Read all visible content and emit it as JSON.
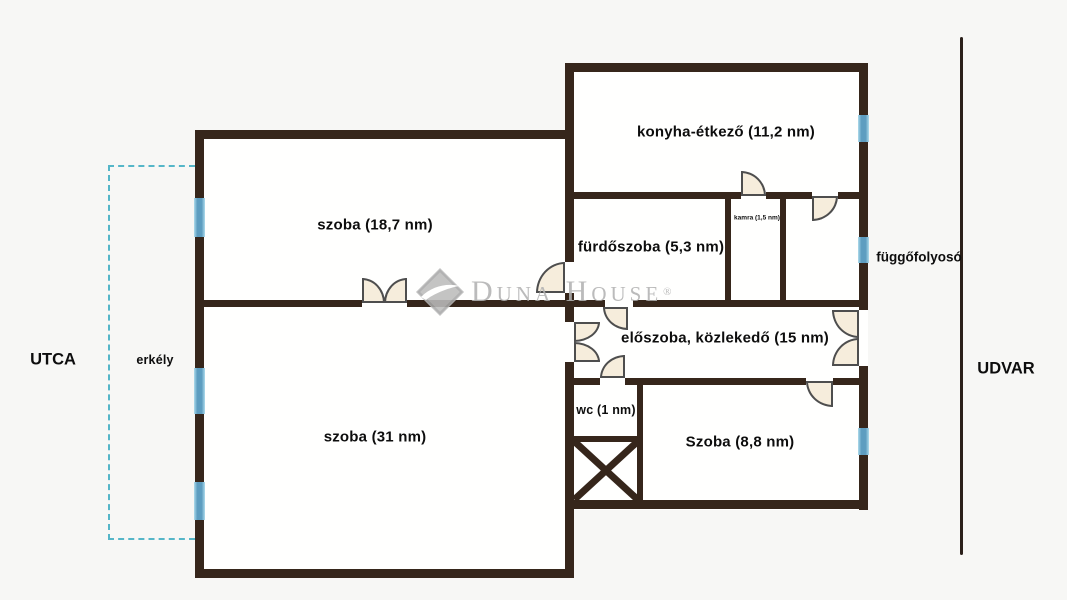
{
  "plan": {
    "rooms": {
      "szoba_187": {
        "label": "szoba (18,7 nm)"
      },
      "szoba_31": {
        "label": "szoba (31 nm)"
      },
      "konyha_etkezo": {
        "label": "konyha-étkező (11,2 nm)"
      },
      "furdoszoba": {
        "label": "fürdőszoba (5,3 nm)"
      },
      "kamra": {
        "label": "kamra (1,5 nm)"
      },
      "eloszoba": {
        "label": "előszoba, közlekedő (15 nm)"
      },
      "wc": {
        "label": "wc (1 nm)"
      },
      "szoba_88": {
        "label": "Szoba (8,8 nm)"
      }
    },
    "exterior": {
      "street_label": "UTCA",
      "courtyard_label": "UDVAR",
      "balcony_label": "erkély",
      "gallery_label": "függőfolyosó"
    }
  },
  "watermark": {
    "brand": "Duna House",
    "registered_mark": "®"
  },
  "colors": {
    "wall": "#36261b",
    "door_fill": "#f6eddc",
    "window_blue": "#5d9dc0",
    "balcony_dash": "#55b6c8",
    "watermark_gray": "#b2b2b2"
  }
}
